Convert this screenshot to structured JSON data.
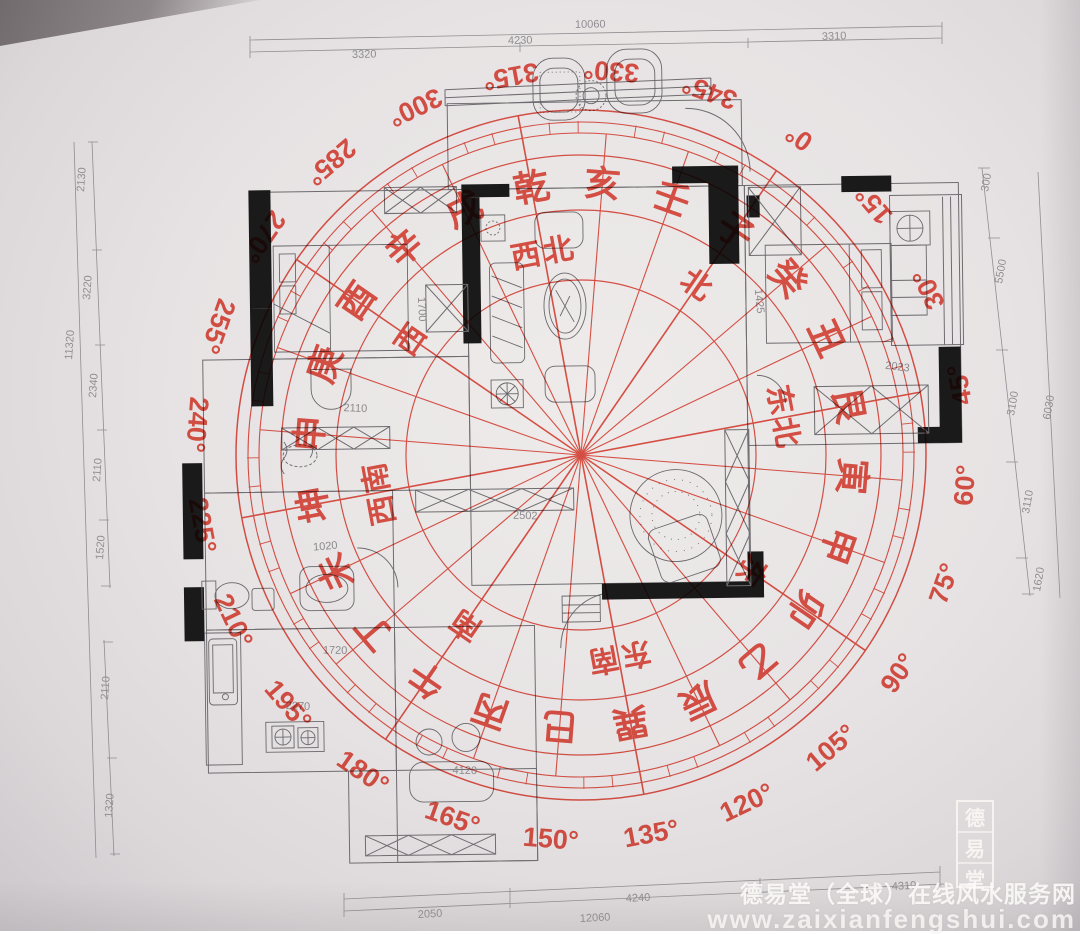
{
  "compass": {
    "color": "#e23a2c",
    "center": {
      "x": 581,
      "y": 455
    },
    "zero_angle": -55.5,
    "degree_label_radius": 385,
    "mountain_radius": 272,
    "direction_radius": 205,
    "tick_inner": 322,
    "tick_outer": 334,
    "line_radius_minor": 322,
    "line_radius_major": 345,
    "rings": [
      {
        "r": 175,
        "w": 1.2
      },
      {
        "r": 245,
        "w": 1.2
      },
      {
        "r": 300,
        "w": 1.2
      },
      {
        "r": 322,
        "w": 1.1
      },
      {
        "r": 333,
        "w": 1.1
      },
      {
        "r": 345,
        "w": 1.5
      }
    ],
    "degree_labels": [
      "0°",
      "15°",
      "30°",
      "45°",
      "60°",
      "75°",
      "90°",
      "105°",
      "120°",
      "135°",
      "150°",
      "165°",
      "180°",
      "195°",
      "210°",
      "225°",
      "240°",
      "255°",
      "270°",
      "285°",
      "300°",
      "315°",
      "330°",
      "345°"
    ],
    "mountains": [
      {
        "char": "子",
        "deg": 0
      },
      {
        "char": "癸",
        "deg": 15
      },
      {
        "char": "丑",
        "deg": 30
      },
      {
        "char": "艮",
        "deg": 45
      },
      {
        "char": "寅",
        "deg": 60
      },
      {
        "char": "甲",
        "deg": 75
      },
      {
        "char": "卯",
        "deg": 90
      },
      {
        "char": "乙",
        "deg": 105
      },
      {
        "char": "辰",
        "deg": 120
      },
      {
        "char": "巽",
        "deg": 135
      },
      {
        "char": "巳",
        "deg": 150
      },
      {
        "char": "丙",
        "deg": 165
      },
      {
        "char": "午",
        "deg": 180
      },
      {
        "char": "丁",
        "deg": 195
      },
      {
        "char": "未",
        "deg": 210
      },
      {
        "char": "坤",
        "deg": 225
      },
      {
        "char": "申",
        "deg": 240
      },
      {
        "char": "庚",
        "deg": 255
      },
      {
        "char": "酉",
        "deg": 270
      },
      {
        "char": "辛",
        "deg": 285
      },
      {
        "char": "戌",
        "deg": 300
      },
      {
        "char": "乾",
        "deg": 315
      },
      {
        "char": "亥",
        "deg": 330
      },
      {
        "char": "壬",
        "deg": 345
      }
    ],
    "directions": [
      {
        "label": "北",
        "deg": 0
      },
      {
        "label": "东北",
        "deg": 45
      },
      {
        "label": "东",
        "deg": 90
      },
      {
        "label": "东南",
        "deg": 135
      },
      {
        "label": "南",
        "deg": 180
      },
      {
        "label": "西南",
        "deg": 225
      },
      {
        "label": "西",
        "deg": 270
      },
      {
        "label": "西北",
        "deg": 315
      }
    ]
  },
  "floor_plan": {
    "dims": {
      "top": {
        "overall": "10060",
        "s1": "3320",
        "s2": "4230",
        "s3": "3310"
      },
      "left": {
        "overall": "11320",
        "s1": "2130",
        "s2": "3220",
        "s3": "2340",
        "s4": "2110",
        "s5": "1520",
        "s6": "2110",
        "s7": "1320"
      },
      "right": {
        "overall": "6030",
        "s1": "300",
        "s2": "5500",
        "s3": "3100",
        "s4": "3110",
        "s5": "1620"
      },
      "bottom": {
        "overall": "12060",
        "s1": "2050",
        "s2": "4240",
        "s3": "4310"
      }
    },
    "interior": {
      "bed1": "1700",
      "hall": "2110",
      "living": "2502",
      "bath": "1020",
      "kitchen1": "1720",
      "kitchen2": "2270",
      "dining": "4120",
      "bed2": "1425",
      "ward2": "2023"
    }
  },
  "watermark": {
    "line1": "德易堂（全球）在线风水服务网",
    "line2": "www.zaixianfengshui.com",
    "seal": [
      "德",
      "易",
      "堂"
    ]
  }
}
